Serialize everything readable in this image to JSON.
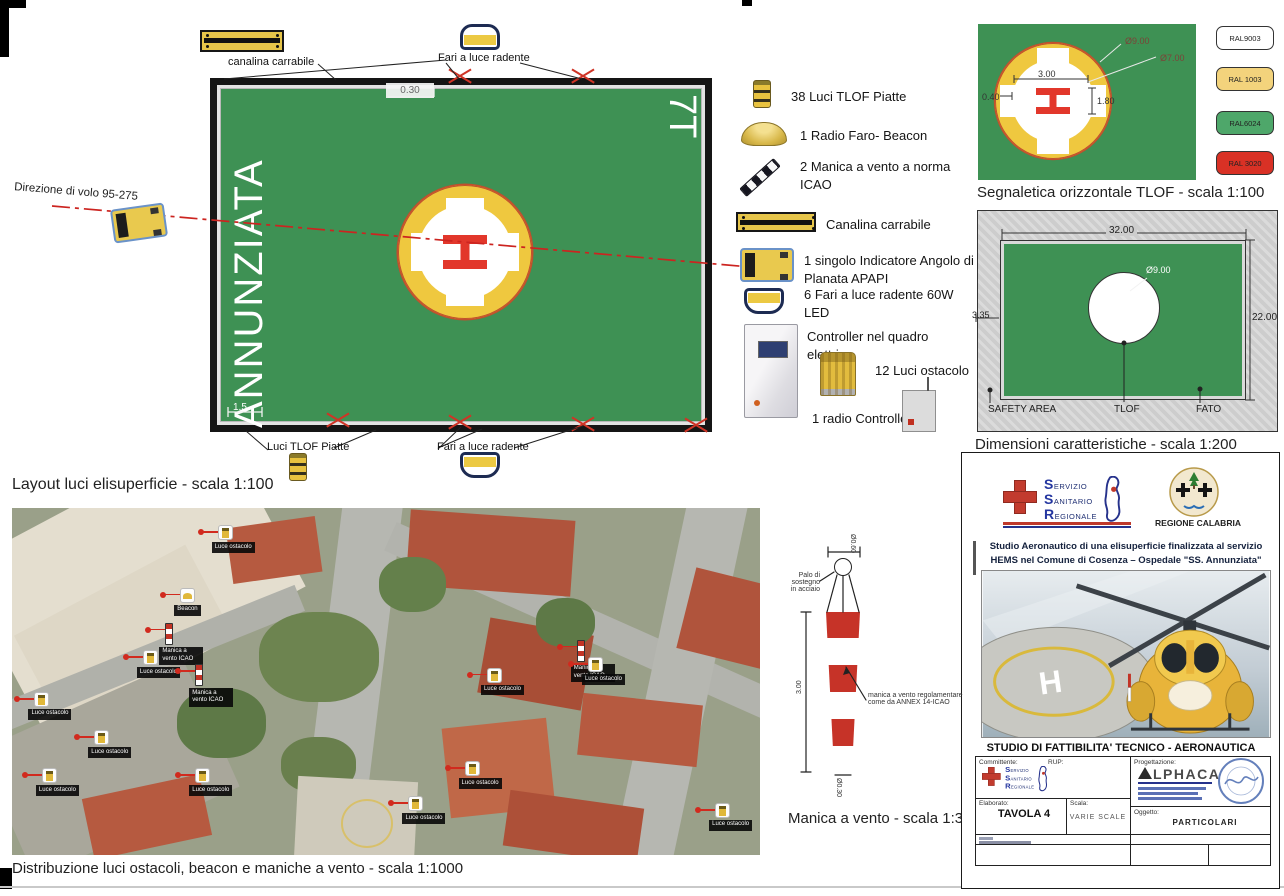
{
  "plan": {
    "caption": "Layout luci elisuperficie - scala 1:100",
    "pad_name": "ANNUNZIATA",
    "heading": "7T",
    "h_mark": "H",
    "dim_edge": "0.30",
    "dim_corner": "1.5",
    "label_canalina": "canalina carrabile",
    "label_fari_top": "Fari a luce radente",
    "label_fari_bottom": "Fari a luce radente",
    "label_tlof_lights": "Luci TLOF Piatte",
    "flight_direction": "Direzione di volo 95-275"
  },
  "legend": {
    "items": [
      {
        "icon": "tlof-light",
        "label": "38 Luci TLOF Piatte"
      },
      {
        "icon": "beacon",
        "label": "1 Radio Faro- Beacon"
      },
      {
        "icon": "windsock",
        "label": "2 Manica a vento a norma ICAO"
      },
      {
        "icon": "canalina",
        "label": "Canalina carrabile"
      },
      {
        "icon": "apapi",
        "label": "1 singolo Indicatore Angolo di Planata APAPI"
      },
      {
        "icon": "flood-light",
        "label": "6 Fari a luce radente 60W LED"
      },
      {
        "icon": "cabinet",
        "label": "Controller nel quadro elettrico"
      },
      {
        "icon": "obstacle-light",
        "label": "12 Luci ostacolo"
      },
      {
        "icon": "radio-controller",
        "label": "1 radio Controller"
      }
    ]
  },
  "tlof_panel": {
    "caption": "Segnaletica orizzontale TLOF - scala 1:100",
    "h_mark": "H",
    "dim_outer": "Ø9.00",
    "dim_inner": "Ø7.00",
    "dim_cross": "3.00",
    "dim_h_stroke": "0.40",
    "dim_h_height": "1.80"
  },
  "ral": {
    "swatches": [
      {
        "label": "RAL9003",
        "color": "#ffffff"
      },
      {
        "label": "RAL 1003",
        "color": "#f3d37c"
      },
      {
        "label": "RAL6024",
        "color": "#4ea76a"
      },
      {
        "label": "RAL 3020",
        "color": "#d93125"
      }
    ]
  },
  "dim_panel": {
    "caption": "Dimensioni caratteristiche - scala 1:200",
    "dim_width": "32.00",
    "dim_height": "22.00",
    "dim_offset": "3.35",
    "dim_circle": "Ø9.00",
    "label_safety": "SAFETY AREA",
    "label_tlof": "TLOF",
    "label_fato": "FATO"
  },
  "map": {
    "caption": "Distribuzione luci ostacoli, beacon e maniche a vento - scala 1:1000",
    "markers": [
      {
        "type": "luce",
        "x": 27.5,
        "y": 5,
        "label": "Luce ostacolo"
      },
      {
        "type": "beacon",
        "x": 22.5,
        "y": 23,
        "label": "Beacon"
      },
      {
        "type": "manica",
        "x": 20.5,
        "y": 33,
        "label": "Manica a vento ICAO"
      },
      {
        "type": "luce",
        "x": 17.5,
        "y": 41,
        "label": "Luce ostacolo"
      },
      {
        "type": "manica",
        "x": 24.5,
        "y": 45,
        "label": "Manica a vento ICAO"
      },
      {
        "type": "luce",
        "x": 3,
        "y": 53,
        "label": "Luce ostacolo"
      },
      {
        "type": "luce",
        "x": 11,
        "y": 64,
        "label": "Luce ostacolo"
      },
      {
        "type": "luce",
        "x": 4,
        "y": 75,
        "label": "Luce ostacolo"
      },
      {
        "type": "luce",
        "x": 24.5,
        "y": 75,
        "label": "Luce ostacolo"
      },
      {
        "type": "manica",
        "x": 75.5,
        "y": 38,
        "label": "Manica a vento ICAO"
      },
      {
        "type": "luce",
        "x": 77,
        "y": 43,
        "label": "Luce ostacolo"
      },
      {
        "type": "luce",
        "x": 63.5,
        "y": 46,
        "label": "Luce ostacolo"
      },
      {
        "type": "luce",
        "x": 60.5,
        "y": 73,
        "label": "Luce ostacolo"
      },
      {
        "type": "luce",
        "x": 53,
        "y": 83,
        "label": "Luce ostacolo"
      },
      {
        "type": "luce",
        "x": 94,
        "y": 85,
        "label": "Luce ostacolo"
      }
    ]
  },
  "windsock": {
    "caption": "Manica a vento - scala 1:30",
    "label_pole_1": "Palo di sostegno",
    "label_pole_2": "in acciaio",
    "label_sock_1": "manica a vento regolamentare",
    "label_sock_2": "come da ANNEX 14-ICAO",
    "dim_top": "Ø0.60",
    "dim_height": "3.00",
    "dim_bottom": "Ø0.30"
  },
  "titleblock": {
    "ssr_lines": [
      "Servizio",
      "Sanitario",
      "Regionale"
    ],
    "region": "REGIONE CALABRIA",
    "project_title": "Studio Aeronautico di una elisuperficie finalizzata al servizio HEMS nel Comune di Cosenza – Ospedale \"SS. Annunziata\"",
    "study_title": "STUDIO DI FATTIBILITA' TECNICO - AERONAUTICA",
    "heli_h": "H",
    "committente": "Committente:",
    "rup": "RUP:",
    "progettazione": "Progettazione:",
    "elaborato": "Elaborato:",
    "tavola": "TAVOLA 4",
    "scala": "Scala:",
    "scala_value": "VARIE SCALE",
    "oggetto": "Oggetto:",
    "oggetto_value": "PARTICOLARI",
    "alphaca": "LPHACA"
  }
}
